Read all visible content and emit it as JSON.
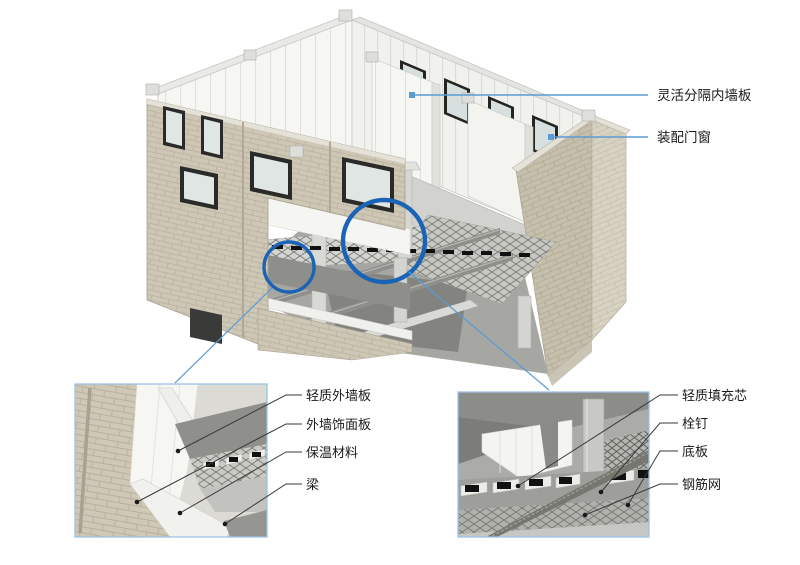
{
  "figure": {
    "type": "prefabricated-building-assembly-diagram",
    "background": "#ffffff",
    "colors": {
      "callout_line_blue": "#5B9BD5",
      "magnifier_circle_blue": "#1B64B5",
      "detail_box_border": "#9DC3E6",
      "leader_line_dark": "#3a3a3a",
      "label_text": "#1a1a1a",
      "brick": "#CFC8B6",
      "panel_white": "#F6F6F3",
      "slab_gray": "#D2D2CF"
    },
    "main_callouts": [
      {
        "label": "灵活分隔内墙板"
      },
      {
        "label": "装配门窗"
      }
    ],
    "left_detail": {
      "labels": [
        "轻质外墙板",
        "外墙饰面板",
        "保温材料",
        "梁"
      ]
    },
    "right_detail": {
      "labels": [
        "轻质填充芯",
        "栓钉",
        "底板",
        "钢筋网"
      ]
    }
  }
}
